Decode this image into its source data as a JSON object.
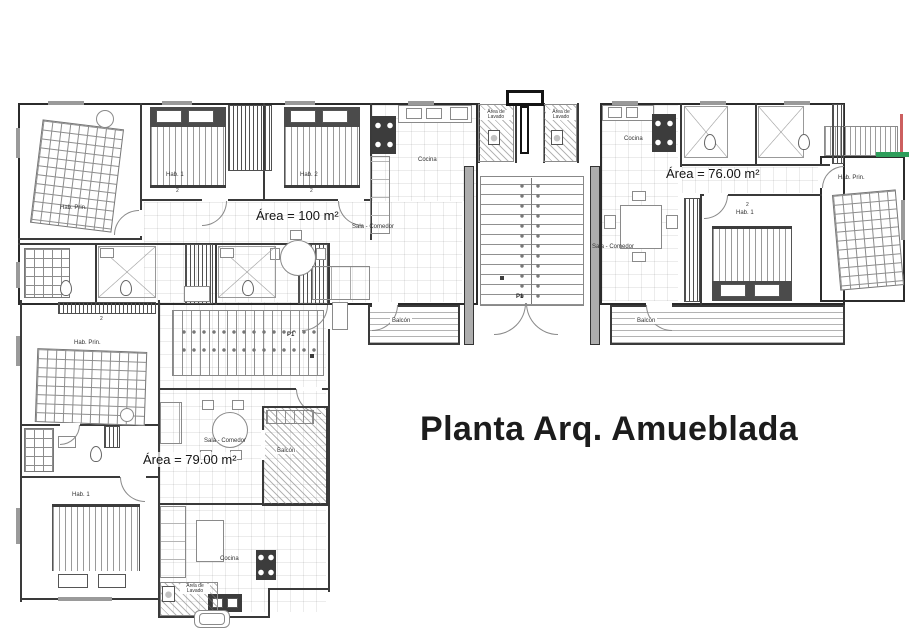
{
  "title": "Planta Arq. Amueblada",
  "areas": {
    "apt_top_left": "Área = 100 m²",
    "apt_top_right": "Área = 76.00 m²",
    "apt_bottom_left": "Área = 79.00 m²"
  },
  "rooms": {
    "hab_prin": "Hab. Prin.",
    "hab_1": "Hab. 1",
    "hab_2": "Hab. 2",
    "cocina": "Cocina",
    "sala_comedor": "Sala - Comedor",
    "area_lavado": "Área de Lavado",
    "balcon": "Balcón"
  },
  "markers": {
    "door_p1": "P1",
    "closet": "2"
  },
  "annotations": {
    "red_line_color": "#cc5f5f",
    "green_line_color": "#2e9e5b"
  }
}
